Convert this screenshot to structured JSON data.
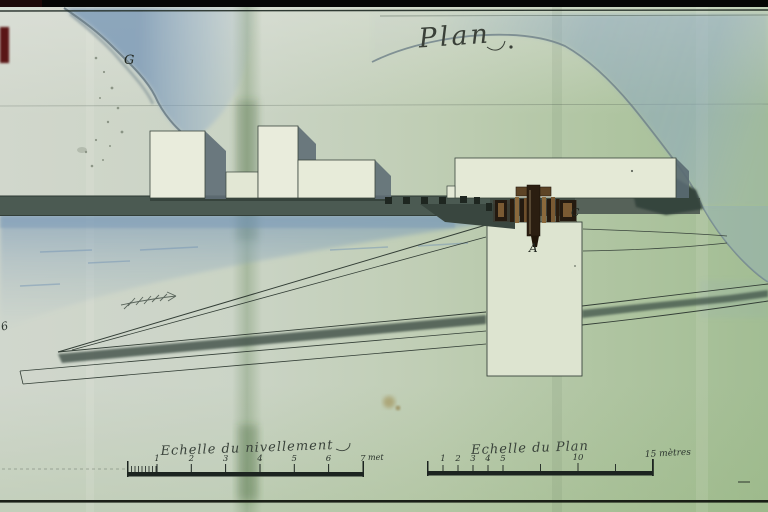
{
  "plan": {
    "title": "Plan",
    "labels": {
      "g": "G",
      "c": "C",
      "a": "A",
      "margin": "6"
    }
  },
  "scales": {
    "left": {
      "label": "Echelle du nivellement",
      "unit": "met",
      "ticks": [
        "1",
        "2",
        "3",
        "4",
        "5",
        "6",
        "7"
      ]
    },
    "right": {
      "label": "Echelle du Plan",
      "ticks": [
        "1",
        "2",
        "3",
        "4",
        "5"
      ],
      "tick_10": "10",
      "end_label": "15 mètres"
    }
  },
  "colors": {
    "paper": "#ccd4c5",
    "paper_green": "#a6bf96",
    "water_blue": "#9db8cd",
    "ink": "#2b342e",
    "quay_shadow": "#46554d",
    "building_fill": "#e9ecdc",
    "cast_shadow": "#5f6e76",
    "wood_dark": "#2a1d10",
    "wood_light": "#8a693c",
    "film_border": "#060606",
    "film_mark": "#5a1515"
  }
}
